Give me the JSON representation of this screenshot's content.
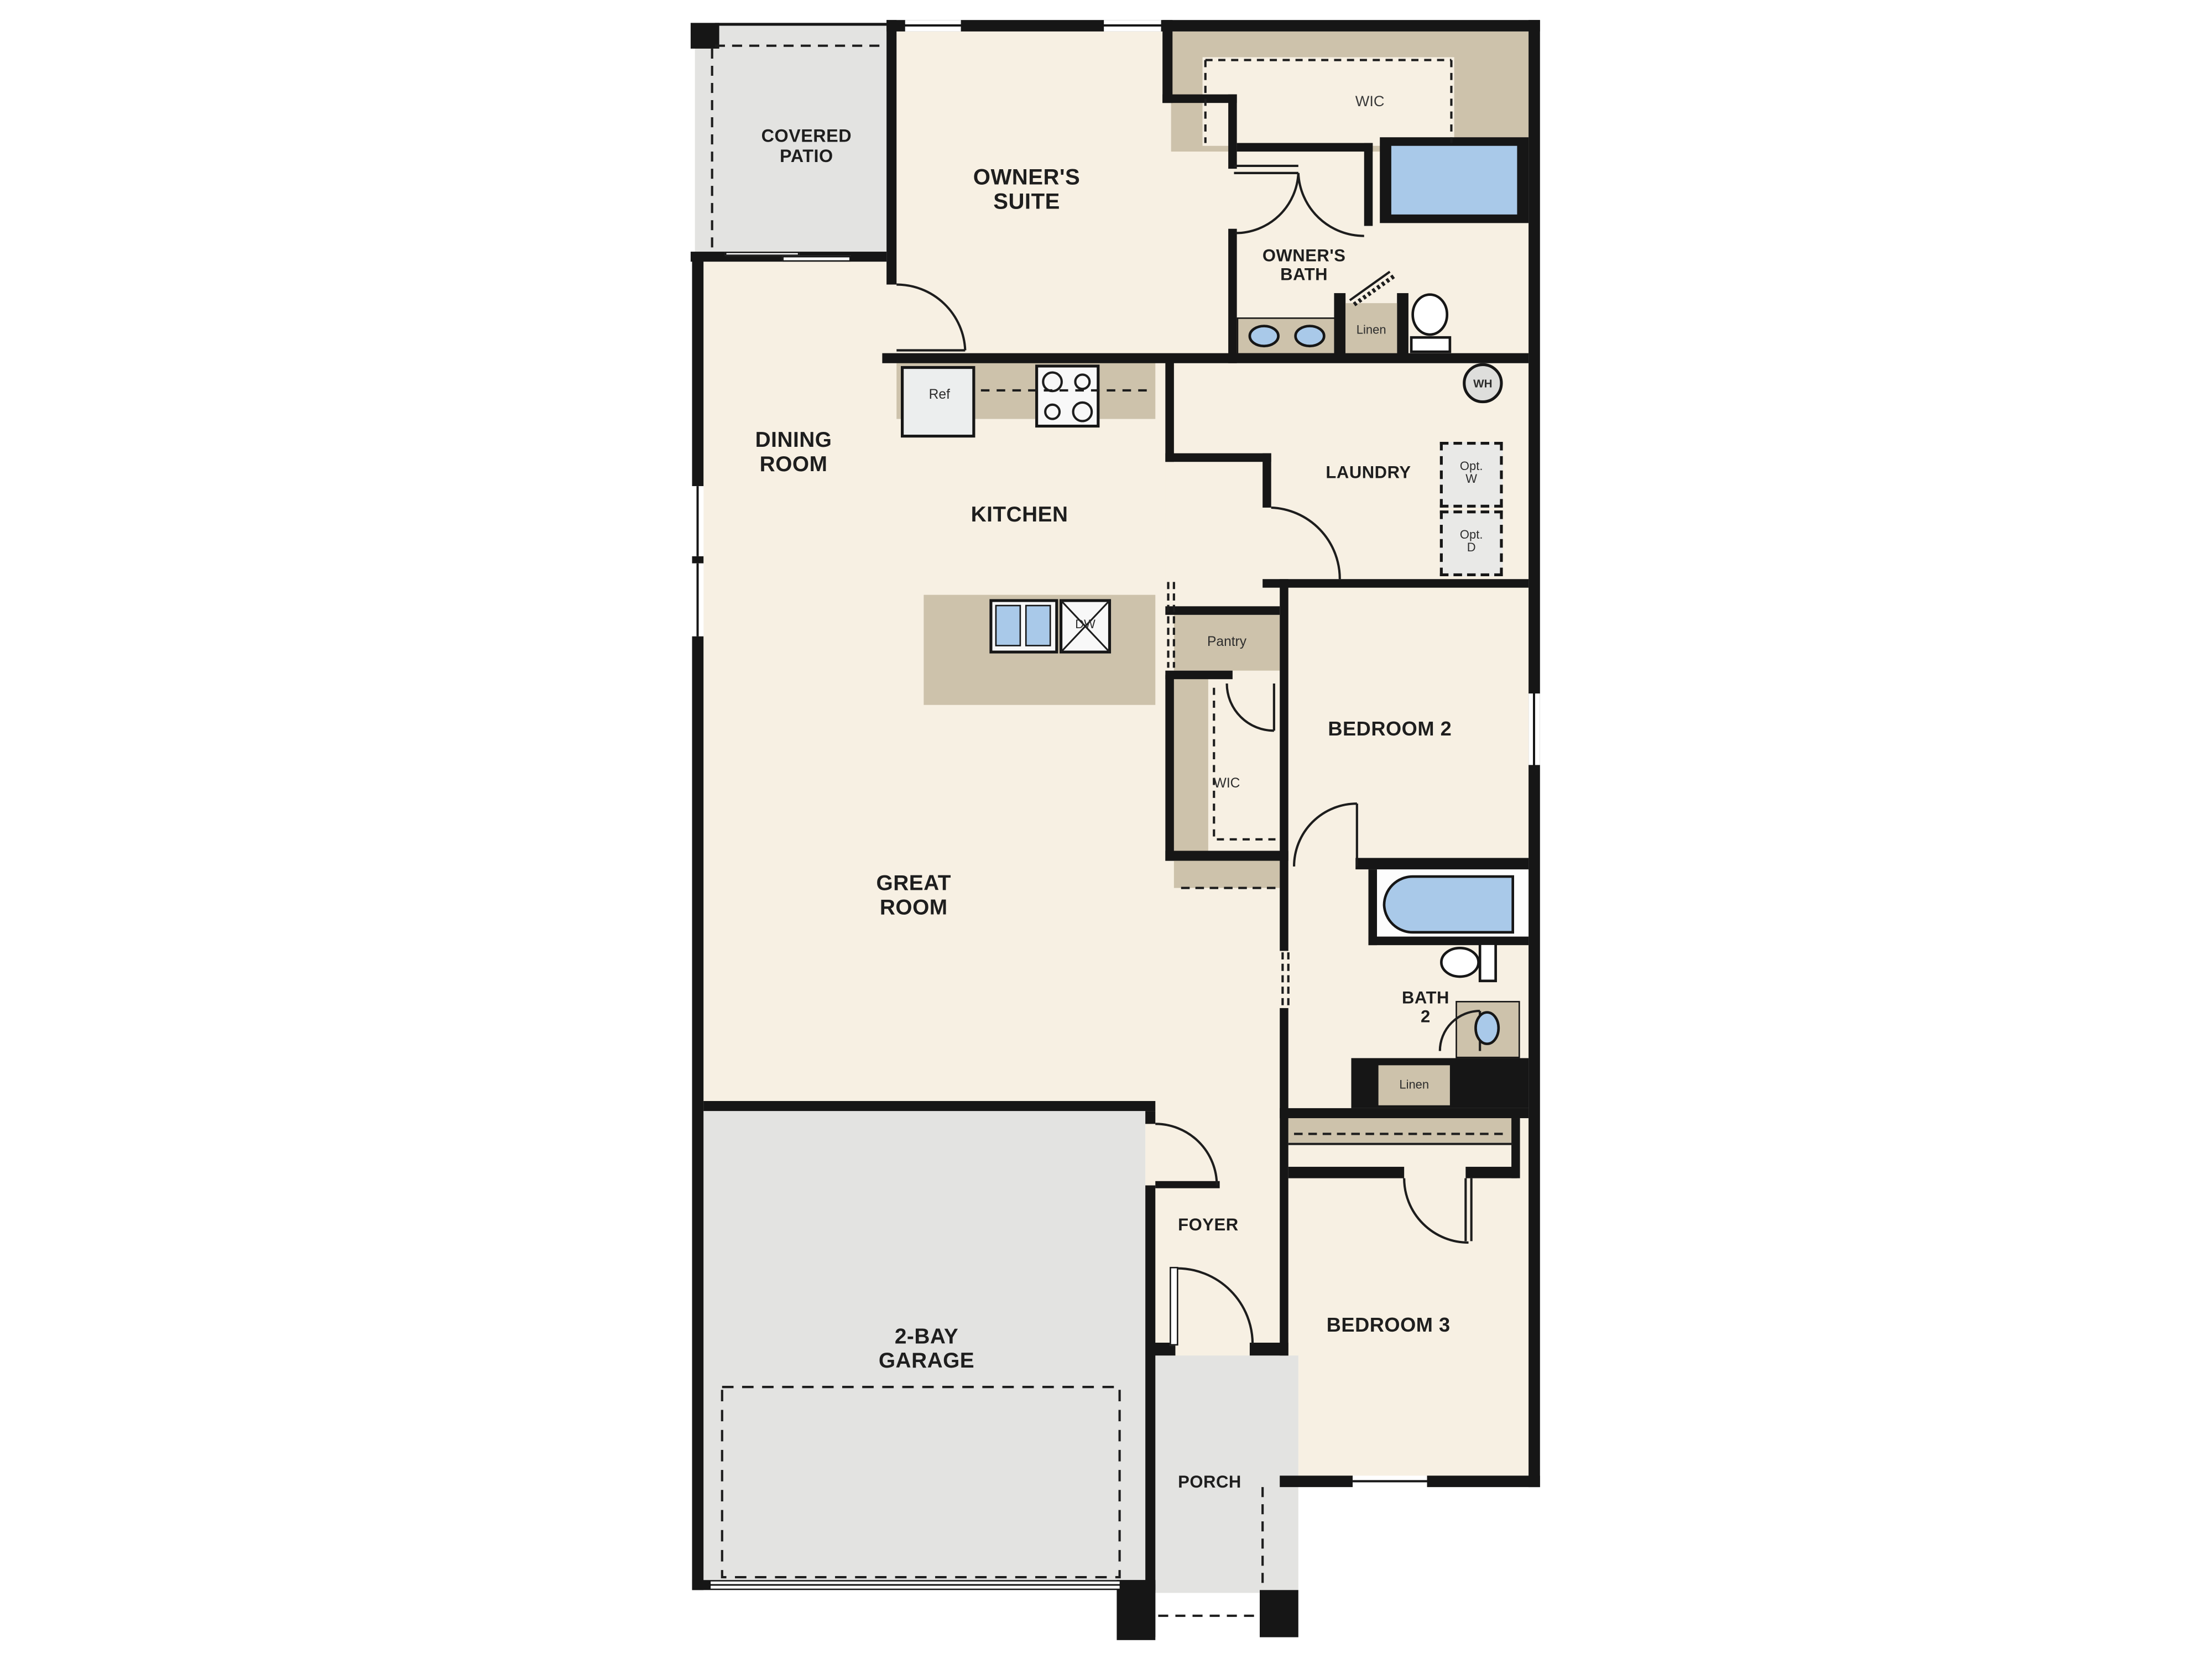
{
  "title": "Single-story 3-bedroom floor plan",
  "colors": {
    "wall": "#161616",
    "floor_interior": "#f7f0e3",
    "floor_outdoor": "#e3e3e1",
    "casework_tan": "#cdc2ab",
    "fixture_blue": "#a9c9e9",
    "background": "#ffffff"
  },
  "labels": {
    "covered_patio_1": "COVERED",
    "covered_patio_2": "PATIO",
    "owners_suite_1": "OWNER'S",
    "owners_suite_2": "SUITE",
    "wic_owner": "WIC",
    "owners_bath_1": "OWNER'S",
    "owners_bath_2": "BATH",
    "linen_owner": "Linen",
    "dining_1": "DINING",
    "dining_2": "ROOM",
    "kitchen": "KITCHEN",
    "ref": "Ref",
    "dw": "DW",
    "pantry": "Pantry",
    "laundry": "LAUNDRY",
    "wh": "WH",
    "opt_w_1": "Opt.",
    "opt_w_2": "W",
    "opt_d_1": "Opt.",
    "opt_d_2": "D",
    "wic_bed2": "WIC",
    "bedroom2": "BEDROOM 2",
    "great_1": "GREAT",
    "great_2": "ROOM",
    "bath2_1": "BATH",
    "bath2_2": "2",
    "linen_bath2": "Linen",
    "foyer": "FOYER",
    "bedroom3": "BEDROOM 3",
    "garage_1": "2-BAY",
    "garage_2": "GARAGE",
    "porch": "PORCH"
  }
}
